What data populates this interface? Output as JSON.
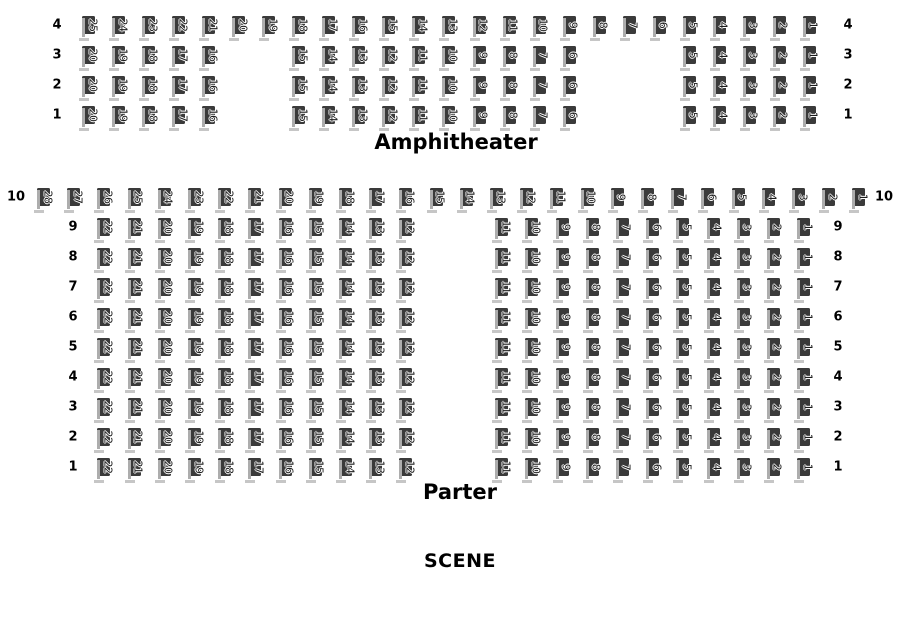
{
  "titles": {
    "amphitheater": "Amphitheater",
    "parter": "Parter",
    "scene": "SCENE"
  },
  "colors": {
    "background": "#ffffff",
    "seat_fill": "#3a3a3a",
    "seat_side": "#adadad",
    "seat_base": "#c6c6c6",
    "seat_number_color": "#1c1c1c",
    "seat_number_outline": "#ffffff",
    "label_color": "#000000"
  },
  "seat": {
    "width": 13,
    "height": 18
  },
  "sections": [
    {
      "id": "amphitheater",
      "grid": {
        "origin_x": 82,
        "origin_y": 16,
        "pitch_x": 30.04,
        "pitch_y": 30
      },
      "left_label_x": 57,
      "right_label_x": 848,
      "rows": [
        {
          "label": "4",
          "r": 0,
          "blocks": [
            {
              "col": 0,
              "seats": [
                25,
                24,
                23,
                22,
                21,
                20,
                19,
                18,
                17,
                16,
                15,
                14,
                13,
                12,
                11,
                10,
                9,
                8,
                7,
                6,
                5,
                4,
                3,
                2,
                1
              ]
            }
          ]
        },
        {
          "label": "3",
          "r": 1,
          "blocks": [
            {
              "col": 0,
              "seats": [
                20,
                19,
                18,
                17,
                16
              ]
            },
            {
              "col": 7,
              "seats": [
                15,
                14,
                13,
                12,
                11,
                10,
                9,
                8,
                7,
                6
              ]
            },
            {
              "col": 20,
              "seats": [
                5,
                4,
                3,
                2,
                1
              ]
            }
          ]
        },
        {
          "label": "2",
          "r": 2,
          "blocks": [
            {
              "col": 0,
              "seats": [
                20,
                19,
                18,
                17,
                16
              ]
            },
            {
              "col": 7,
              "seats": [
                15,
                14,
                13,
                12,
                11,
                10,
                9,
                8,
                7,
                6
              ]
            },
            {
              "col": 20,
              "seats": [
                5,
                4,
                3,
                2,
                1
              ]
            }
          ]
        },
        {
          "label": "1",
          "r": 3,
          "blocks": [
            {
              "col": 0,
              "seats": [
                20,
                19,
                18,
                17,
                16
              ]
            },
            {
              "col": 7,
              "seats": [
                15,
                14,
                13,
                12,
                11,
                10,
                9,
                8,
                7,
                6
              ]
            },
            {
              "col": 20,
              "seats": [
                5,
                4,
                3,
                2,
                1
              ]
            }
          ]
        }
      ]
    },
    {
      "id": "parter",
      "grid": {
        "origin_x": 37,
        "origin_y": 188,
        "pitch_x": 30.2,
        "pitch_y": 30
      },
      "left_label_x": 73,
      "right_label_x": 838,
      "rows": [
        {
          "label": "10",
          "r": 0,
          "left_label_x": 16,
          "right_label_x": 884,
          "blocks": [
            {
              "col": 0,
              "seats": [
                28,
                27,
                26,
                25,
                24,
                23,
                22,
                21,
                20,
                19,
                18,
                17,
                16,
                15,
                14,
                13,
                12,
                11,
                10,
                9,
                8,
                7,
                6,
                5,
                4,
                3,
                2,
                1
              ]
            }
          ]
        },
        {
          "label": "9",
          "r": 1,
          "blocks": [
            {
              "col": 2,
              "seats": [
                22,
                21,
                20,
                19,
                18,
                17,
                16,
                15,
                14,
                13,
                12
              ]
            },
            {
              "col": 15.17,
              "seats": [
                11,
                10,
                9,
                8,
                7,
                6,
                5,
                4,
                3,
                2,
                1
              ]
            }
          ]
        },
        {
          "label": "8",
          "r": 2,
          "blocks": [
            {
              "col": 2,
              "seats": [
                22,
                21,
                20,
                19,
                18,
                17,
                16,
                15,
                14,
                13,
                12
              ]
            },
            {
              "col": 15.17,
              "seats": [
                11,
                10,
                9,
                8,
                7,
                6,
                5,
                4,
                3,
                2,
                1
              ]
            }
          ]
        },
        {
          "label": "7",
          "r": 3,
          "blocks": [
            {
              "col": 2,
              "seats": [
                22,
                21,
                20,
                19,
                18,
                17,
                16,
                15,
                14,
                13,
                12
              ]
            },
            {
              "col": 15.17,
              "seats": [
                11,
                10,
                9,
                8,
                7,
                6,
                5,
                4,
                3,
                2,
                1
              ]
            }
          ]
        },
        {
          "label": "6",
          "r": 4,
          "blocks": [
            {
              "col": 2,
              "seats": [
                22,
                21,
                20,
                19,
                18,
                17,
                16,
                15,
                14,
                13,
                12
              ]
            },
            {
              "col": 15.17,
              "seats": [
                11,
                10,
                9,
                8,
                7,
                6,
                5,
                4,
                3,
                2,
                1
              ]
            }
          ]
        },
        {
          "label": "5",
          "r": 5,
          "blocks": [
            {
              "col": 2,
              "seats": [
                22,
                21,
                20,
                19,
                18,
                17,
                16,
                15,
                14,
                13,
                12
              ]
            },
            {
              "col": 15.17,
              "seats": [
                11,
                10,
                9,
                8,
                7,
                6,
                5,
                4,
                3,
                2,
                1
              ]
            }
          ]
        },
        {
          "label": "4",
          "r": 6,
          "blocks": [
            {
              "col": 2,
              "seats": [
                22,
                21,
                20,
                19,
                18,
                17,
                16,
                15,
                14,
                13,
                12
              ]
            },
            {
              "col": 15.17,
              "seats": [
                11,
                10,
                9,
                8,
                7,
                6,
                5,
                4,
                3,
                2,
                1
              ]
            }
          ]
        },
        {
          "label": "3",
          "r": 7,
          "blocks": [
            {
              "col": 2,
              "seats": [
                22,
                21,
                20,
                19,
                18,
                17,
                16,
                15,
                14,
                13,
                12
              ]
            },
            {
              "col": 15.17,
              "seats": [
                11,
                10,
                9,
                8,
                7,
                6,
                5,
                4,
                3,
                2,
                1
              ]
            }
          ]
        },
        {
          "label": "2",
          "r": 8,
          "blocks": [
            {
              "col": 2,
              "seats": [
                22,
                21,
                20,
                19,
                18,
                17,
                16,
                15,
                14,
                13,
                12
              ]
            },
            {
              "col": 15.17,
              "seats": [
                11,
                10,
                9,
                8,
                7,
                6,
                5,
                4,
                3,
                2,
                1
              ]
            }
          ]
        },
        {
          "label": "1",
          "r": 9,
          "blocks": [
            {
              "col": 2,
              "seats": [
                22,
                21,
                20,
                19,
                18,
                17,
                16,
                15,
                14,
                13,
                12
              ]
            },
            {
              "col": 15.17,
              "seats": [
                11,
                10,
                9,
                8,
                7,
                6,
                5,
                4,
                3,
                2,
                1
              ]
            }
          ]
        }
      ]
    }
  ]
}
